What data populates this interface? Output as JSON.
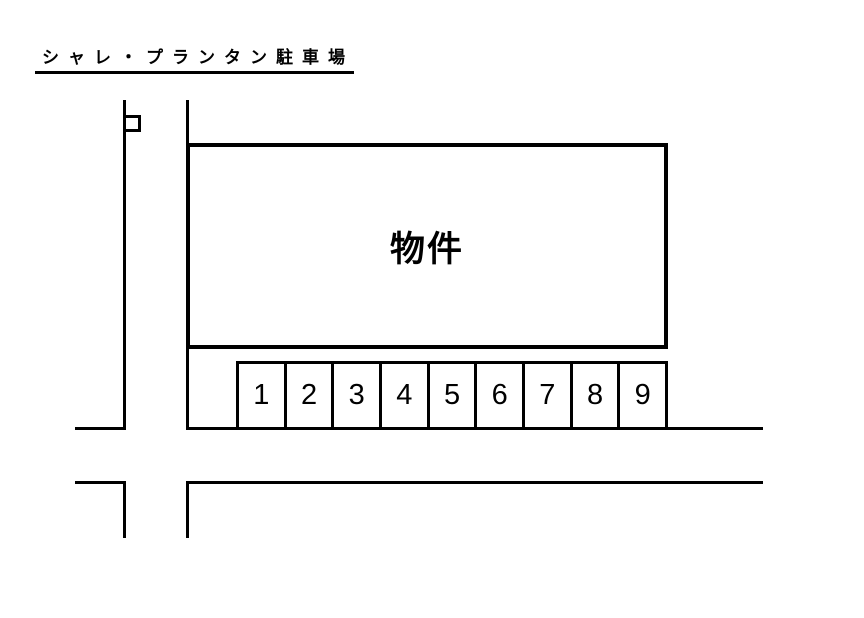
{
  "title": "シャレ・プランタン駐車場",
  "building": {
    "label": "物件"
  },
  "parking": {
    "spaces": [
      "1",
      "2",
      "3",
      "4",
      "5",
      "6",
      "7",
      "8",
      "9"
    ]
  },
  "colors": {
    "line": "#000000",
    "background": "#ffffff"
  }
}
